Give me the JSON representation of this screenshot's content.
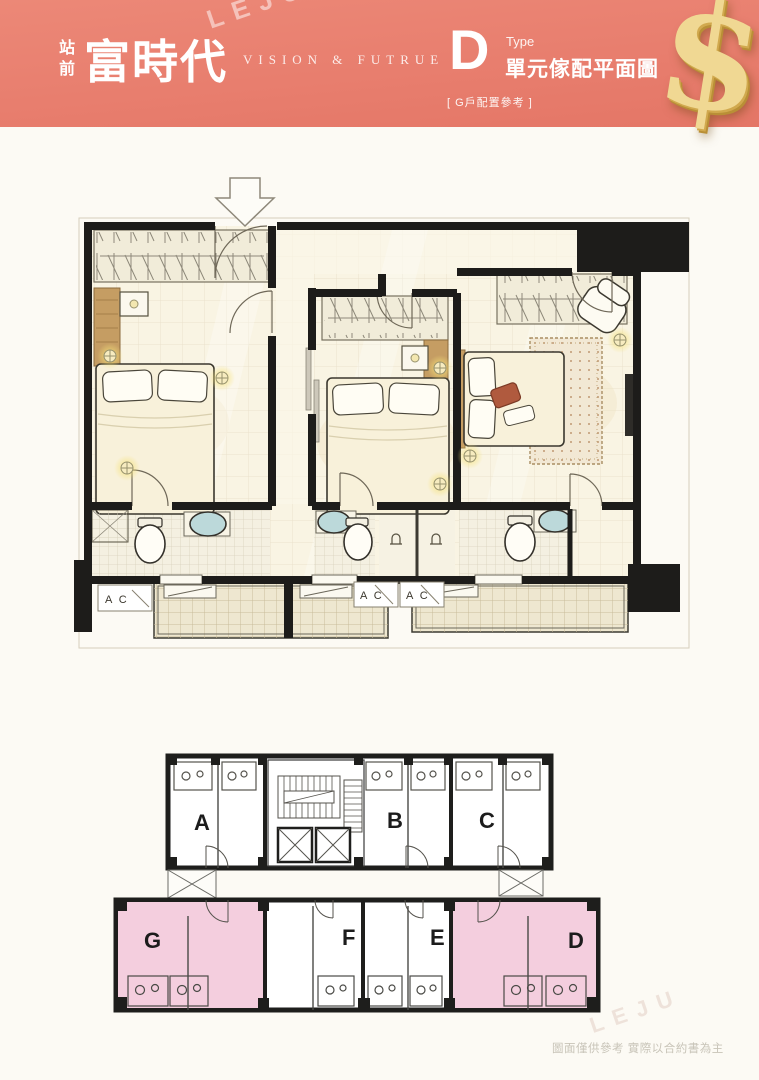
{
  "page": {
    "background": "#fcfaf4"
  },
  "header": {
    "background_color": "#e87e6e",
    "station_prefix_chars": [
      "站",
      "前"
    ],
    "project_name": "富時代",
    "tagline": "VISION & FUTRUE",
    "unit_type_letter": "D",
    "unit_type_word": "Type",
    "unit_type_title": "單元傢配平面圖",
    "unit_type_note": "[ G戶配置參考 ]",
    "dollar_symbol": "$",
    "gold_color": "#dfbc63"
  },
  "floor_plan": {
    "entry_arrow_icon": "down-arrow",
    "ac_labels": [
      "A C",
      "A C",
      "A C"
    ],
    "wall_color": "#1d1c1a",
    "floor_color": "#f9f4e3"
  },
  "key_plan": {
    "top_units": [
      {
        "label": "A"
      },
      {
        "label": "B"
      },
      {
        "label": "C"
      }
    ],
    "bottom_units": [
      {
        "label": "G"
      },
      {
        "label": "F"
      },
      {
        "label": "E"
      },
      {
        "label": "D"
      }
    ],
    "highlight_color": "#f4cede"
  },
  "footer": {
    "disclaimer": "圖面僅供參考 實際以合約書為主"
  },
  "watermark": {
    "text": "LEJU"
  }
}
